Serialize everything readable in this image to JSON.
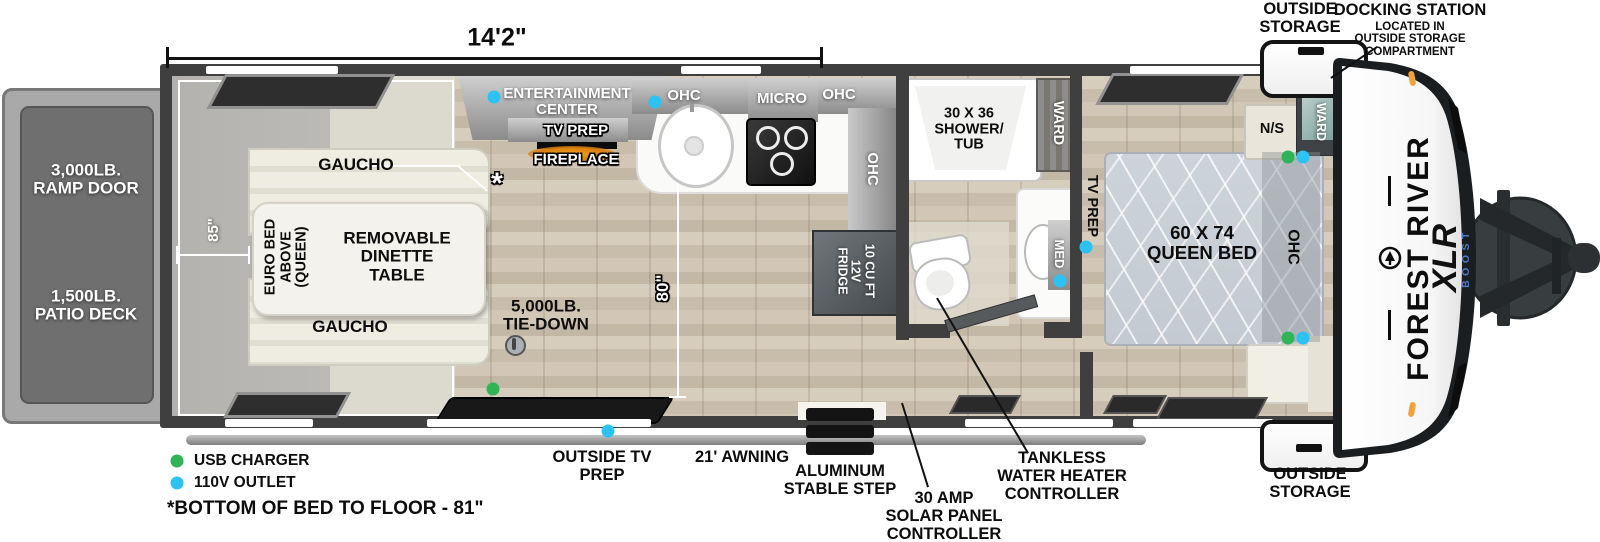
{
  "colors": {
    "usb_green": "#2fb457",
    "outlet_110v": "#2cc3f2",
    "marker_orange": "#f1a23b",
    "boost_blue": "#4a7ac8"
  },
  "dims": {
    "length": "14'2\"",
    "garage_width": "85\"",
    "living_width": "80\""
  },
  "exterior": {
    "ramp_door": "3,000LB.\nRAMP DOOR",
    "patio_deck": "1,500LB.\nPATIO DECK",
    "storage_top": "OUTSIDE\nSTORAGE",
    "storage_bottom": "OUTSIDE\nSTORAGE",
    "docking_title": "DOCKING STATION",
    "docking_sub": "LOCATED IN\nOUTSIDE STORAGE\nCOMPARTMENT",
    "outside_tv": "OUTSIDE TV\nPREP",
    "awning": "21' AWNING",
    "step": "ALUMINUM\nSTABLE STEP",
    "solar": "30 AMP\nSOLAR PANEL\nCONTROLLER",
    "tankless": "TANKLESS\nWATER HEATER\nCONTROLLER"
  },
  "legend": {
    "usb": "USB CHARGER",
    "outlet": "110V OUTLET",
    "footnote": "*BOTTOM OF BED TO FLOOR - 81\""
  },
  "garage": {
    "gaucho_top": "GAUCHO",
    "gaucho_bottom": "GAUCHO",
    "dinette": "REMOVABLE\nDINETTE\nTABLE",
    "euro_bed": "EURO BED\nABOVE\n(QUEEN)",
    "tie_down": "5,000LB.\nTIE-DOWN",
    "asterisk": "*"
  },
  "living": {
    "entertainment": "ENTERTAINMENT\nCENTER",
    "tv_prep": "TV PREP",
    "fireplace": "FIREPLACE"
  },
  "kitchen": {
    "ohc_left": "OHC",
    "micro": "MICRO",
    "ohc_right": "OHC",
    "ohc_side": "OHC",
    "fridge": "10 CU FT\n12V\nFRIDGE"
  },
  "bath": {
    "shower": "30 X 36\nSHOWER/\nTUB",
    "ward": "WARD",
    "med": "MED"
  },
  "bedroom": {
    "tv_prep": "TV PREP",
    "ns": "N/S",
    "ward": "WARD",
    "bed": "60 X 74\nQUEEN BED",
    "ohc": "OHC"
  },
  "brand": {
    "name": "FOREST RIVER",
    "model": "XLR",
    "sub": "BOOST"
  }
}
